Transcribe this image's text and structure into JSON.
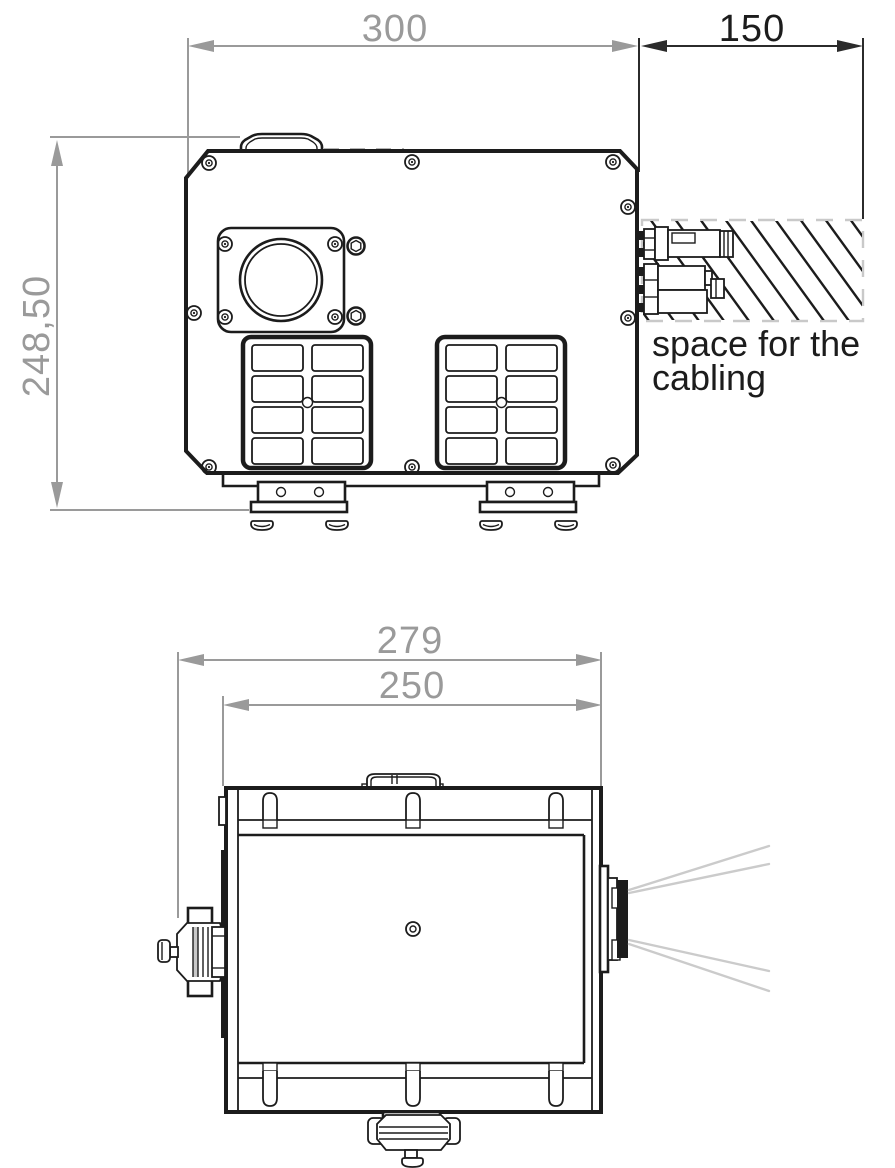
{
  "drawing": {
    "front_view": {
      "dim_width": "300",
      "dim_cabling_space": "150",
      "dim_height": "248,50",
      "cabling_note_line1": "space for the",
      "cabling_note_line2": "cabling"
    },
    "top_view": {
      "dim_overall_width": "279",
      "dim_body_width": "250"
    },
    "colors": {
      "line_black": "#1c1c1c",
      "dimension_gray": "#9a9a9a",
      "hatch_border_gray": "#c9c9c9",
      "light_ray_gray": "#cbcbcb",
      "background": "#ffffff"
    }
  }
}
